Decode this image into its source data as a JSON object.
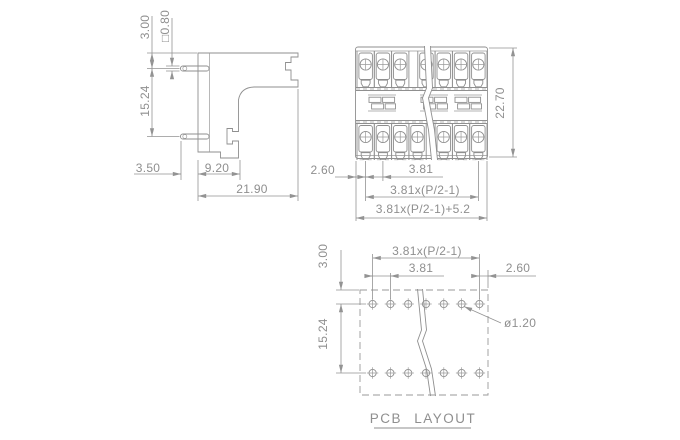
{
  "title": "PCB LAYOUT",
  "colors": {
    "line": "#8f8f8f",
    "text": "#8f8f8f",
    "background": "#ffffff"
  },
  "side_view": {
    "name": "connector side view",
    "dims": {
      "pin_offset_top": "3.00",
      "pin_square_size": "□0.80",
      "pin_row_spacing": "15.24",
      "pin_length": "3.50",
      "front_depth": "9.20",
      "total_depth": "21.90"
    }
  },
  "front_view": {
    "name": "connector front view",
    "dims": {
      "total_height": "22.70",
      "end_margin": "2.60",
      "pin_pitch": "3.81",
      "pin_span": "3.81x(P/2-1)",
      "total_width": "3.81x(P/2-1)+5.2"
    }
  },
  "pcb_layout": {
    "title": "PCB LAYOUT",
    "dims": {
      "hole_span": "3.81x(P/2-1)",
      "hole_pitch": "3.81",
      "end_margin": "2.60",
      "row_offset_top": "3.00",
      "row_spacing": "15.24",
      "hole_diameter": "ø1.20"
    }
  }
}
